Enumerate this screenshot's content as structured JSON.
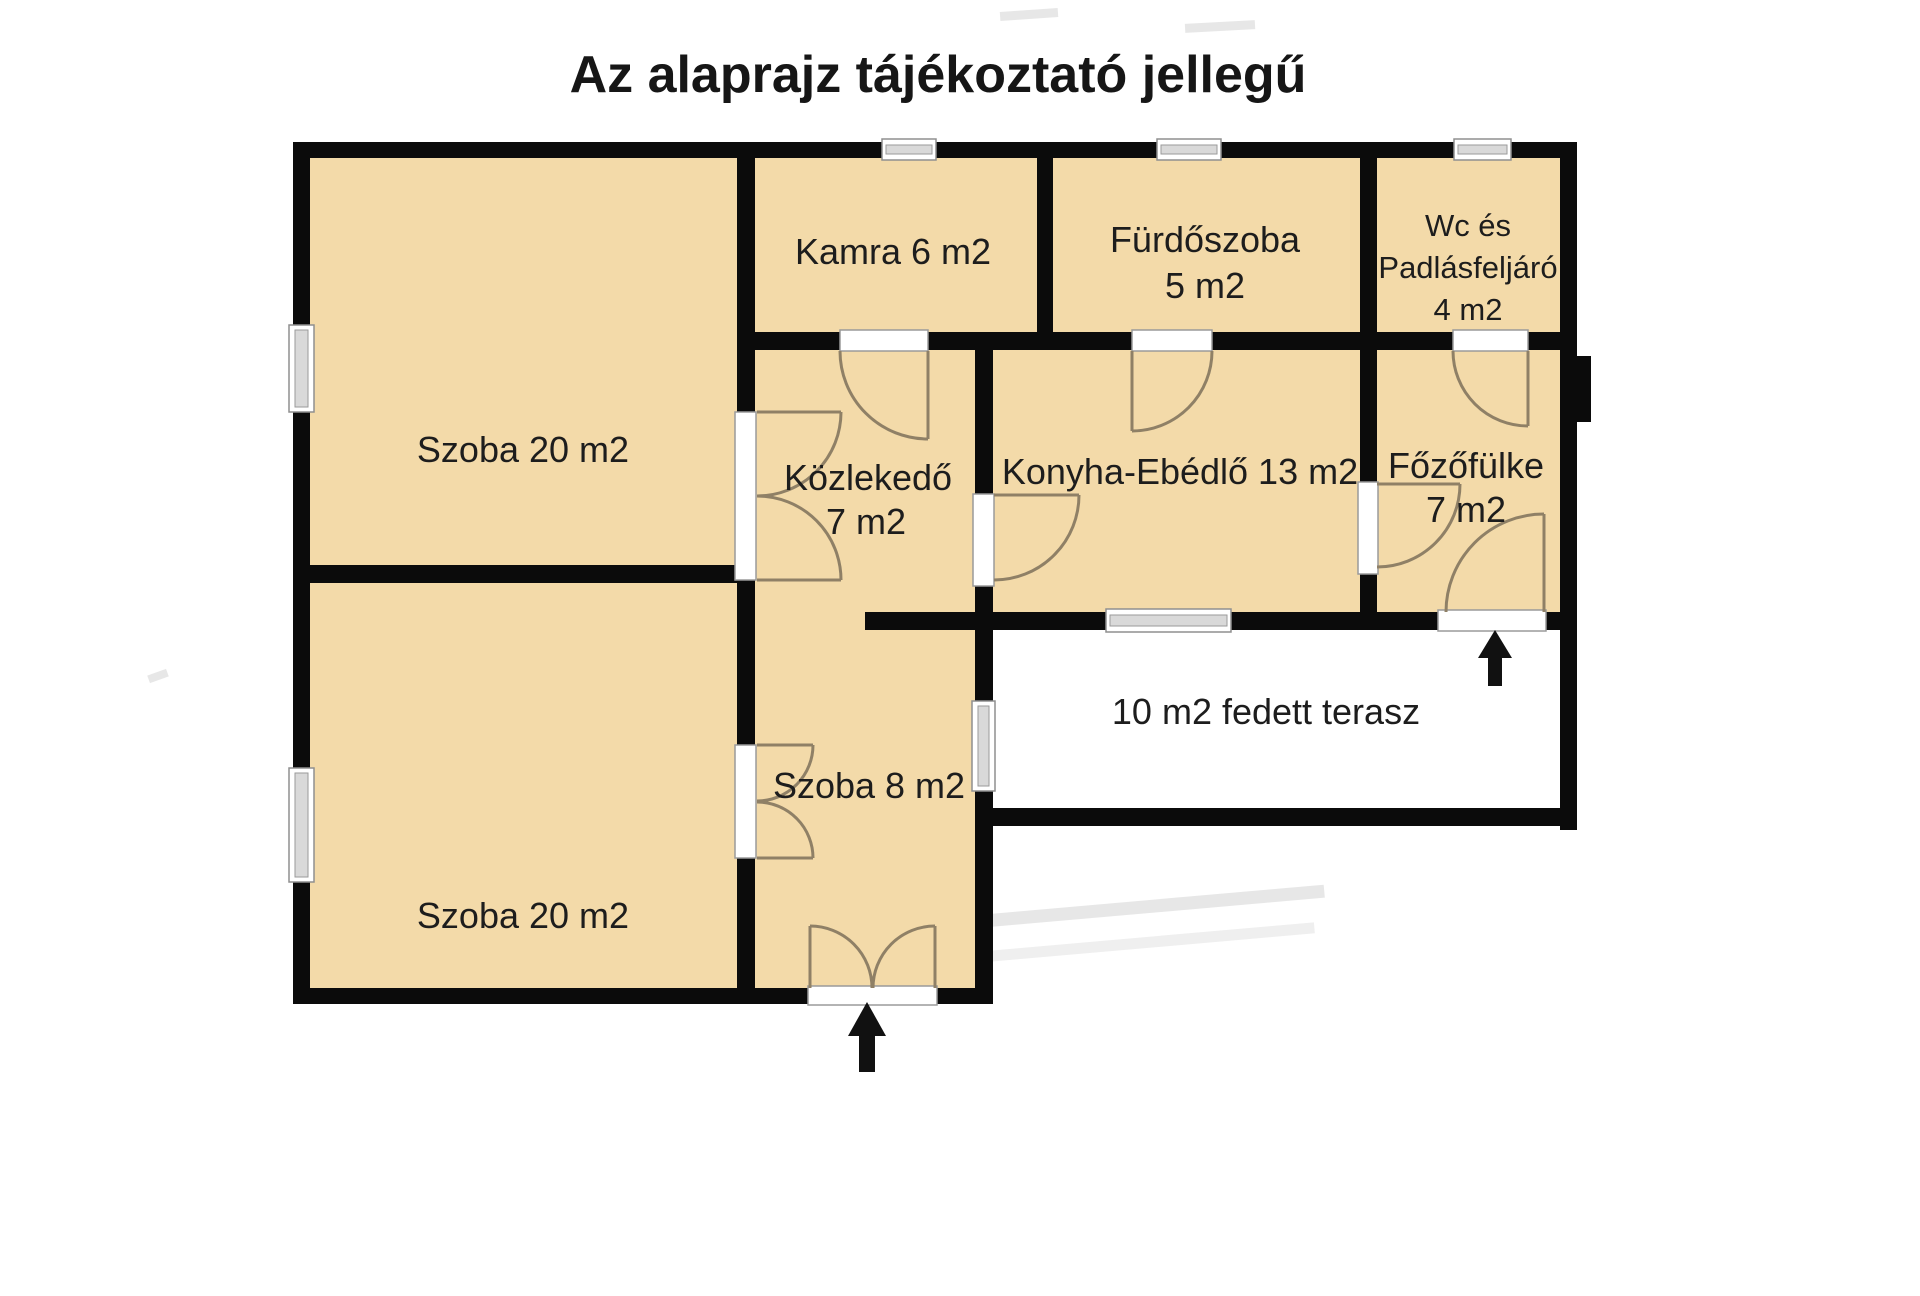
{
  "title": "Az alaprajz tájékoztató jellegű",
  "colors": {
    "wall": "#0b0b0b",
    "room_fill": "#f3daa9",
    "door_line": "#8f8066",
    "arrow": "#111111",
    "text": "#1d1d1d"
  },
  "rooms": {
    "szoba_felso": {
      "label": "Szoba 20 m2"
    },
    "szoba_also": {
      "label": "Szoba 20 m2"
    },
    "kamra": {
      "label": "Kamra 6 m2"
    },
    "furdoszoba": {
      "label": "Fürdőszoba",
      "area": "5 m2"
    },
    "wc_padlasfeljaro": {
      "line1": "Wc  és",
      "line2": "Padlásfeljáró",
      "line3": "4  m2"
    },
    "kozlekedo": {
      "label": "Közlekedő",
      "area": "7 m2"
    },
    "konyha_ebedlo": {
      "label": "Konyha-Ebédlő 13 m2"
    },
    "fozofulke": {
      "label": "Főzőfülke",
      "area": "7 m2"
    },
    "szoba8": {
      "label": "Szoba 8 m2"
    },
    "terasz": {
      "label": "10 m2 fedett terasz"
    }
  }
}
